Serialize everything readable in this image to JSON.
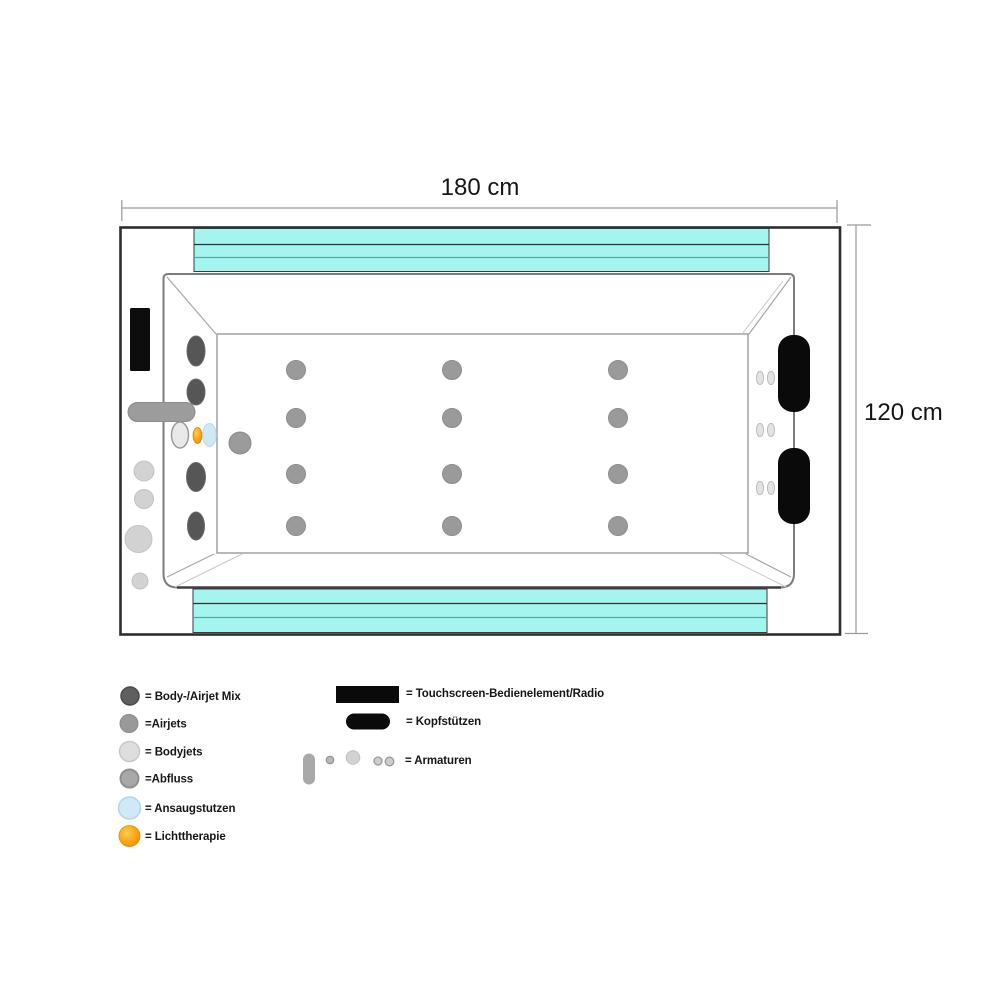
{
  "dimensions": {
    "width_label": "180 cm",
    "height_label": "120 cm"
  },
  "legend": {
    "left": [
      {
        "name": "body-airjet-mix",
        "label": "= Body-/Airjet Mix"
      },
      {
        "name": "airjets",
        "label": "=Airjets"
      },
      {
        "name": "bodyjets",
        "label": "= Bodyjets"
      },
      {
        "name": "abfluss",
        "label": "=Abfluss"
      },
      {
        "name": "ansaugstutzen",
        "label": "= Ansaugstutzen"
      },
      {
        "name": "lichttherapie",
        "label": "= Lichttherapie"
      }
    ],
    "right": [
      {
        "name": "touchscreen",
        "label": "= Touchscreen-Bedienelement/Radio"
      },
      {
        "name": "kopfstuetzen",
        "label": "= Kopfstützen"
      },
      {
        "name": "armaturen",
        "label": "= Armaturen"
      }
    ]
  },
  "colors": {
    "cyan_band": "#a4f5f0",
    "teal_divider": "#4fa8a2",
    "outline_dark": "#2e2e2e",
    "headrest_black": "#0a0a0a",
    "mixjet_dark_gray": "#565656",
    "airjet_gray": "#9a9a9a",
    "bodyjet_light_gray": "#e9e9e9",
    "ansaug_light_blue": "#cfe8f6",
    "licht_orange": "#f5a623"
  },
  "fixtures": [
    {
      "type": "touchscreen",
      "shape": "rect",
      "x": 130,
      "y": 308,
      "w": 20,
      "h": 63,
      "r": 1.5
    },
    {
      "type": "mixjet",
      "shape": "ellipse",
      "cx": 196,
      "cy": 351,
      "rx": 9,
      "ry": 15
    },
    {
      "type": "mixjet",
      "shape": "ellipse",
      "cx": 196,
      "cy": 392,
      "rx": 9,
      "ry": 13
    },
    {
      "type": "mixjet",
      "shape": "ellipse",
      "cx": 196,
      "cy": 477,
      "rx": 9.5,
      "ry": 14.5
    },
    {
      "type": "mixjet",
      "shape": "ellipse",
      "cx": 196,
      "cy": 526,
      "rx": 8.5,
      "ry": 14
    },
    {
      "type": "armatur-handle",
      "shape": "rect",
      "x": 128,
      "y": 402.5,
      "w": 67,
      "h": 19,
      "r": 9.5
    },
    {
      "type": "bodyjet",
      "shape": "ellipse",
      "cx": 180,
      "cy": 435,
      "rx": 8.5,
      "ry": 13
    },
    {
      "type": "lichttherapie",
      "shape": "ellipse",
      "cx": 197.5,
      "cy": 435.5,
      "rx": 4.5,
      "ry": 8
    },
    {
      "type": "ansaugstutzen",
      "shape": "ellipse",
      "cx": 209.5,
      "cy": 435,
      "rx": 6.8,
      "ry": 11.5
    },
    {
      "type": "abfluss",
      "shape": "circle",
      "cx": 240,
      "cy": 443,
      "r": 11
    },
    {
      "type": "armatur",
      "shape": "circle",
      "cx": 144,
      "cy": 471,
      "r": 10
    },
    {
      "type": "armatur",
      "shape": "circle",
      "cx": 144,
      "cy": 499,
      "r": 9.5
    },
    {
      "type": "armatur",
      "shape": "circle",
      "cx": 138.5,
      "cy": 539,
      "r": 13.5
    },
    {
      "type": "armatur",
      "shape": "circle",
      "cx": 140,
      "cy": 581,
      "r": 8
    },
    {
      "type": "airjet",
      "shape": "circle",
      "cx": 296,
      "cy": 370,
      "r": 9.5
    },
    {
      "type": "airjet",
      "shape": "circle",
      "cx": 452,
      "cy": 370,
      "r": 9.5
    },
    {
      "type": "airjet",
      "shape": "circle",
      "cx": 618,
      "cy": 370,
      "r": 9.5
    },
    {
      "type": "airjet",
      "shape": "circle",
      "cx": 296,
      "cy": 418,
      "r": 9.5
    },
    {
      "type": "airjet",
      "shape": "circle",
      "cx": 452,
      "cy": 418,
      "r": 9.5
    },
    {
      "type": "airjet",
      "shape": "circle",
      "cx": 618,
      "cy": 418,
      "r": 9.5
    },
    {
      "type": "airjet",
      "shape": "circle",
      "cx": 296,
      "cy": 474,
      "r": 9.5
    },
    {
      "type": "airjet",
      "shape": "circle",
      "cx": 452,
      "cy": 474,
      "r": 9.5
    },
    {
      "type": "airjet",
      "shape": "circle",
      "cx": 618,
      "cy": 474,
      "r": 9.5
    },
    {
      "type": "airjet",
      "shape": "circle",
      "cx": 296,
      "cy": 526,
      "r": 9.5
    },
    {
      "type": "airjet",
      "shape": "circle",
      "cx": 452,
      "cy": 526,
      "r": 9.5
    },
    {
      "type": "airjet",
      "shape": "circle",
      "cx": 618,
      "cy": 526,
      "r": 9.5
    },
    {
      "type": "walljet",
      "shape": "ellipse",
      "cx": 760,
      "cy": 378,
      "rx": 3.6,
      "ry": 6.6
    },
    {
      "type": "walljet",
      "shape": "ellipse",
      "cx": 771,
      "cy": 378,
      "rx": 3.6,
      "ry": 6.6
    },
    {
      "type": "walljet",
      "shape": "ellipse",
      "cx": 760,
      "cy": 430,
      "rx": 3.6,
      "ry": 6.6
    },
    {
      "type": "walljet",
      "shape": "ellipse",
      "cx": 771,
      "cy": 430,
      "rx": 3.6,
      "ry": 6.6
    },
    {
      "type": "walljet",
      "shape": "ellipse",
      "cx": 760,
      "cy": 488,
      "rx": 3.6,
      "ry": 6.6
    },
    {
      "type": "walljet",
      "shape": "ellipse",
      "cx": 771,
      "cy": 488,
      "rx": 3.6,
      "ry": 6.6
    },
    {
      "type": "headrest",
      "shape": "rect",
      "x": 778,
      "y": 335,
      "w": 32,
      "h": 77,
      "r": 15
    },
    {
      "type": "headrest",
      "shape": "rect",
      "x": 778,
      "y": 448,
      "w": 32,
      "h": 76,
      "r": 15
    }
  ]
}
